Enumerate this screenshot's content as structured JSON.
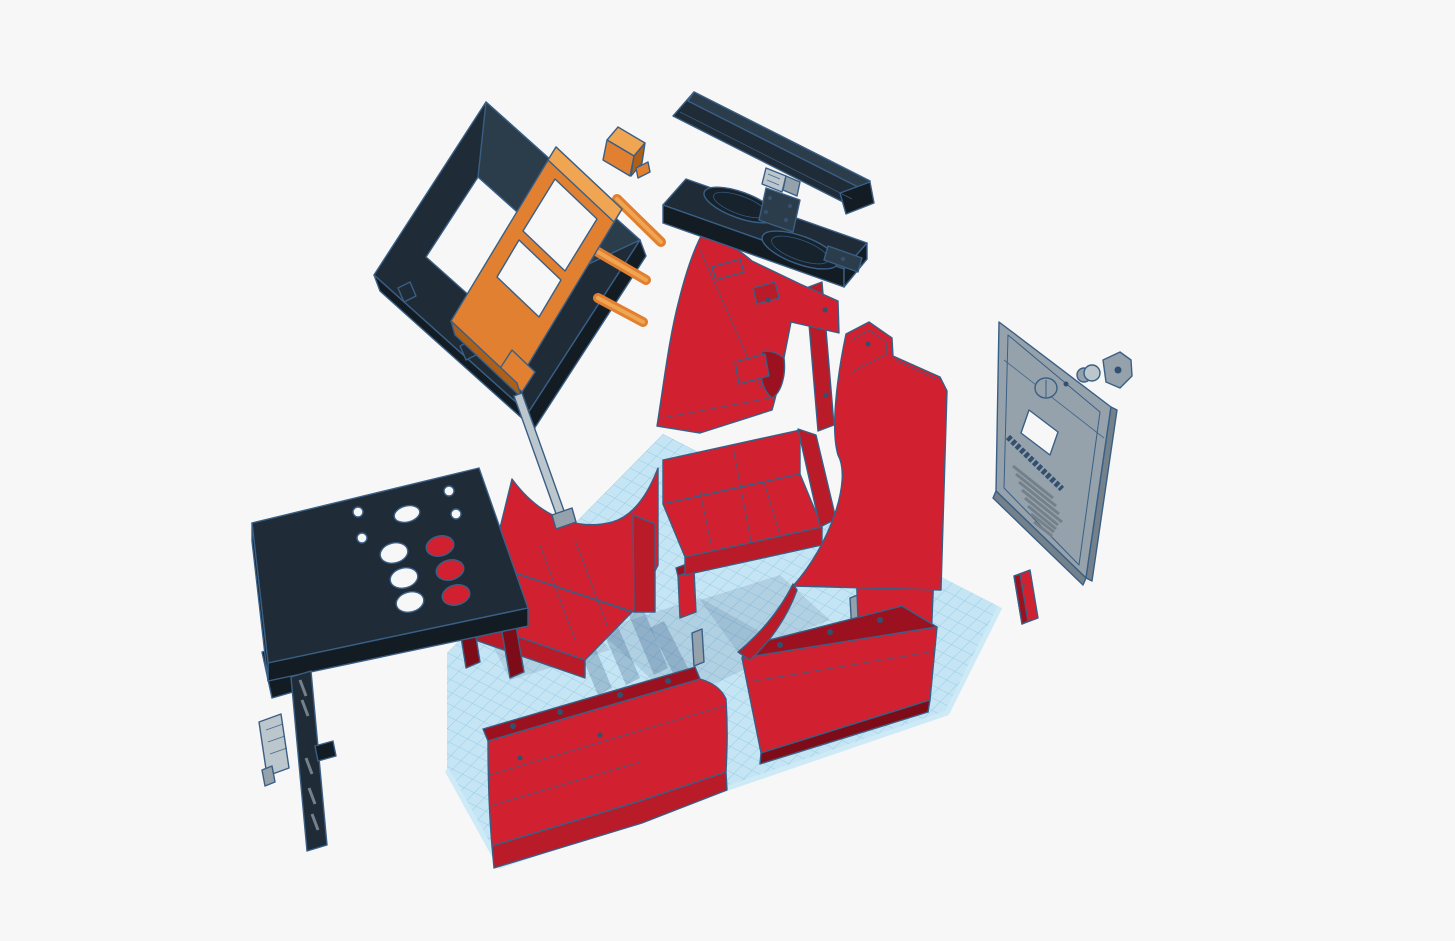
{
  "app": {
    "name": "3d-cad-viewport",
    "scene": "Exploded view of a tabletop arcade cabinet 3D model floating above a blue grid workplane"
  },
  "canvas": {
    "background": "#f7f7f8",
    "topbar_color": "#ececf1",
    "topbar_border": "#dadbe4"
  },
  "colors": {
    "bg": "#f7f7f8",
    "red": "#d12030",
    "red_mid": "#b91b29",
    "red_dark": "#9c1120",
    "red_deep": "#7e0c18",
    "black": "#1f2b36",
    "black_face": "#2b3c4a",
    "black_dark": "#131b23",
    "speaker_dark": "#16222c",
    "orange": "#e08030",
    "orange_dark": "#b05f17",
    "orange_light": "#f0a552",
    "gray": "#95a2ac",
    "gray_light": "#bcc6cd",
    "gray_dark": "#74818b",
    "outline": "#3a5f85",
    "navy_detail": "#33506e",
    "grid_base": "#c6e5f4",
    "grid_line": "#93cbe4",
    "grid_edge": "#cdeaf6",
    "shadow": "rgba(58,95,133,0.28)",
    "shadow_soft": "rgba(58,95,133,0.15)",
    "hole": "#f7f7f8"
  },
  "parts": [
    {
      "id": "workplane-grid",
      "color": "#c6e5f4"
    },
    {
      "id": "bezel-frame",
      "color": "#1f2b36"
    },
    {
      "id": "monitor-mount-frame",
      "color": "#e08030"
    },
    {
      "id": "mount-bracket",
      "color": "#e08030"
    },
    {
      "id": "marquee-panel",
      "color": "#1f2b36"
    },
    {
      "id": "hinge-bracket",
      "color": "#95a2ac"
    },
    {
      "id": "speaker-panel",
      "color": "#1f2b36"
    },
    {
      "id": "side-panel-left",
      "color": "#d12030"
    },
    {
      "id": "side-panel-right",
      "color": "#d12030"
    },
    {
      "id": "back-door",
      "color": "#95a2ac"
    },
    {
      "id": "cam-lock",
      "color": "#95a2ac"
    },
    {
      "id": "lock-plate",
      "color": "#95a2ac"
    },
    {
      "id": "red-strip",
      "color": "#d12030"
    },
    {
      "id": "control-panel",
      "color": "#1f2b36"
    },
    {
      "id": "slotted-strip",
      "color": "#1f2b36"
    },
    {
      "id": "small-plate",
      "color": "#bcc6cd"
    },
    {
      "id": "base-box-left",
      "color": "#d12030"
    },
    {
      "id": "base-box-right",
      "color": "#d12030"
    },
    {
      "id": "base-box-rear-right",
      "color": "#d12030"
    },
    {
      "id": "front-panel-left",
      "color": "#d12030"
    },
    {
      "id": "front-panel-right",
      "color": "#d12030"
    },
    {
      "id": "support-stick",
      "color": "#bcc6cd"
    },
    {
      "id": "red-post",
      "color": "#d12030"
    },
    {
      "id": "gray-posts",
      "color": "#95a2ac"
    }
  ]
}
